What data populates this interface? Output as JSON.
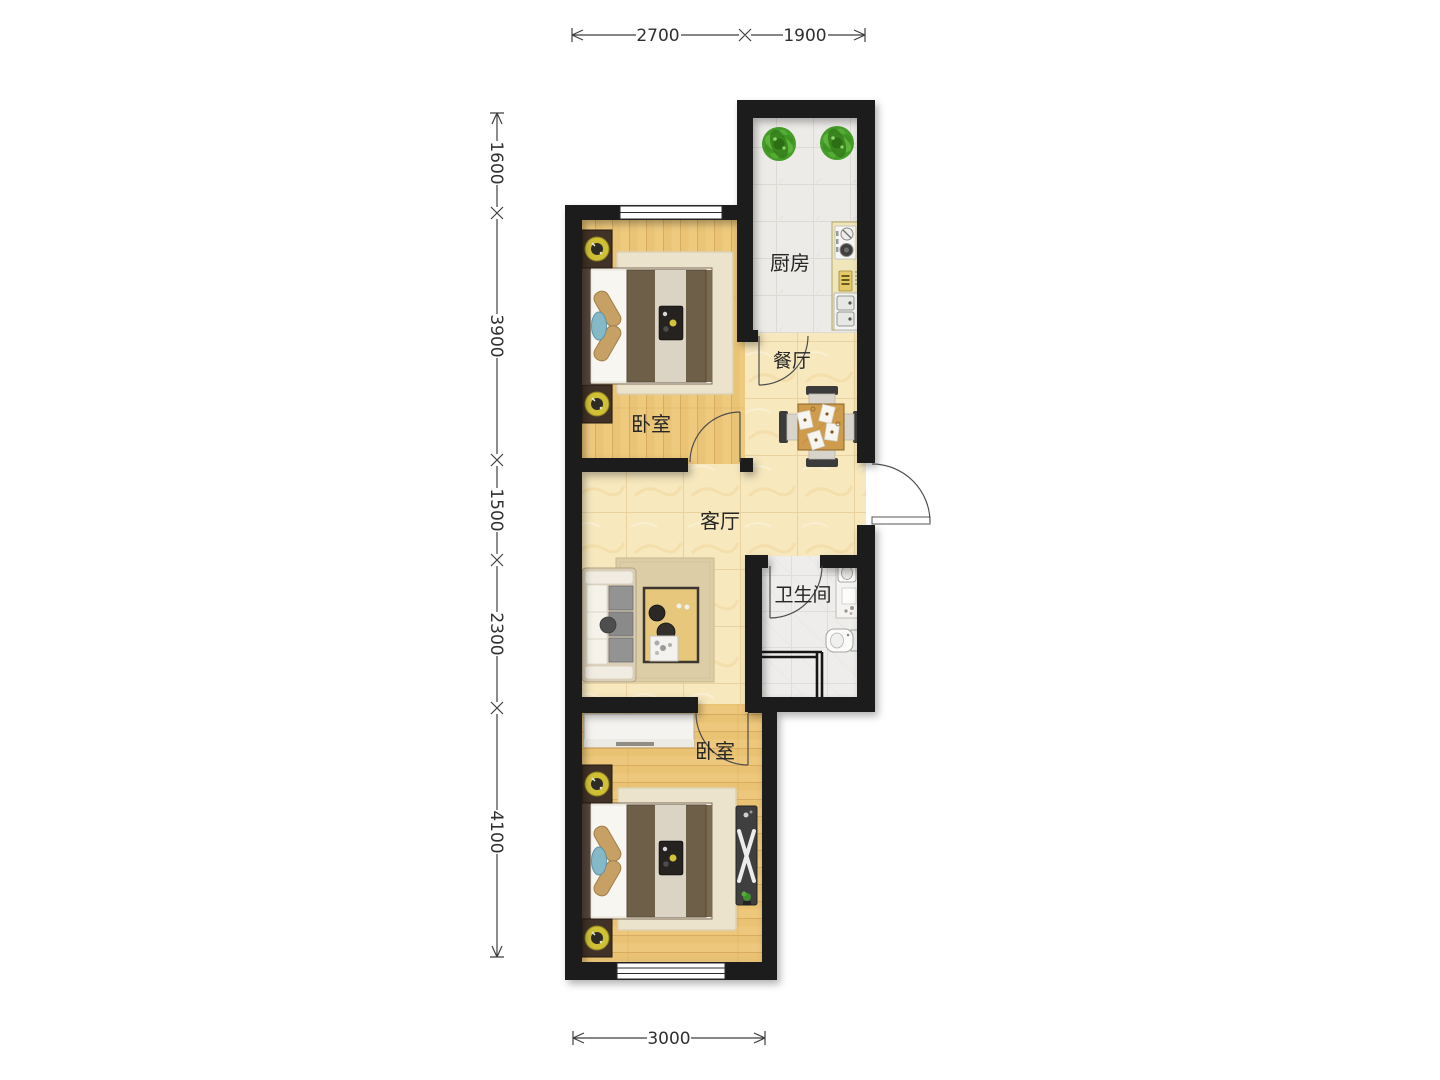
{
  "plan_title": "two-bedroom apartment floor plan",
  "rooms": {
    "kitchen": {
      "label": "厨房"
    },
    "dining": {
      "label": "餐厅"
    },
    "bedroom_north": {
      "label": "卧室"
    },
    "living": {
      "label": "客厅"
    },
    "bathroom": {
      "label": "卫生间"
    },
    "bedroom_south": {
      "label": "卧室"
    }
  },
  "dimensions": {
    "top": [
      {
        "label": "2700"
      },
      {
        "label": "1900"
      }
    ],
    "left": [
      {
        "label": "1600"
      },
      {
        "label": "3900"
      },
      {
        "label": "1500"
      },
      {
        "label": "2300"
      },
      {
        "label": "4100"
      }
    ],
    "bottom": [
      {
        "label": "3000"
      }
    ]
  },
  "palette": {
    "wall": "#1b1b1b",
    "wood_floor": "#ecc87e",
    "marble_floor": "#f6e6ba",
    "white_tile": "#ebe9e6",
    "counter": "#efe6ba",
    "lamp_accent": "#cfc035",
    "plant_green": "#459c28",
    "blanket_brown": "#6e5f48",
    "label_text": "#262626",
    "dimension_text": "#2f2f2f"
  }
}
